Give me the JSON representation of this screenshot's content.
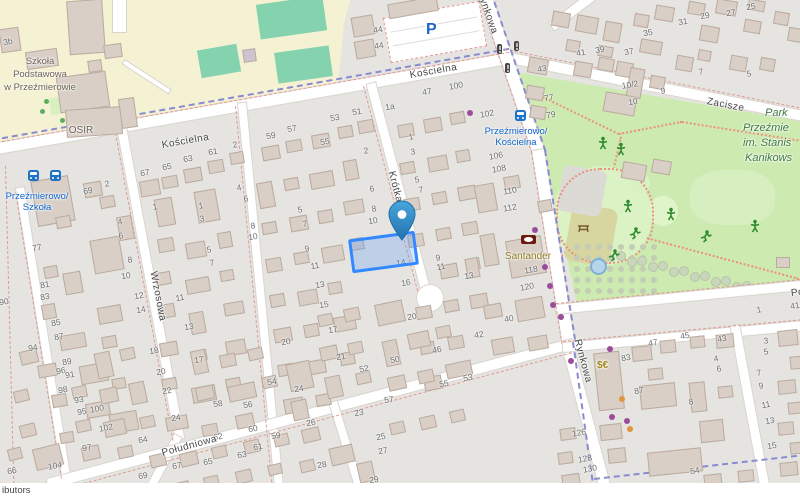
{
  "map": {
    "attribution_fragment": "ibutors",
    "streets": [
      {
        "name": "Kościelna"
      },
      {
        "name": "Kościelna"
      },
      {
        "name": "Zacisze"
      },
      {
        "name": "Wrzosowa"
      },
      {
        "name": "Krótka"
      },
      {
        "name": "Rynkowa"
      },
      {
        "name": "Rynkowa"
      },
      {
        "name": "Południowa"
      },
      {
        "name": "Południowa"
      }
    ],
    "places": {
      "school_lines": [
        "Szkoła",
        "Podstawowa",
        "w Przeźmierowie"
      ],
      "osir": "OSIR",
      "park_lines": [
        "Park",
        "Przeźmie",
        "im. Stanis",
        "Kanikows"
      ],
      "santander": "Santander",
      "parking": "P",
      "currency": "$€"
    },
    "bus_stops": [
      {
        "name_lines": [
          "Przeźmierowo/",
          "Szkoła"
        ]
      },
      {
        "name_lines": [
          "Przeźmierowo/",
          "Kościelna"
        ]
      }
    ],
    "house_numbers": [
      {
        "t": "3b",
        "x": 8,
        "y": 42
      },
      {
        "t": "44",
        "x": 378,
        "y": 30
      },
      {
        "t": "44",
        "x": 379,
        "y": 46
      },
      {
        "t": "100",
        "x": 456,
        "y": 86
      },
      {
        "t": "47",
        "x": 427,
        "y": 92
      },
      {
        "t": "1a",
        "x": 390,
        "y": 107
      },
      {
        "t": "102",
        "x": 487,
        "y": 114
      },
      {
        "t": "1",
        "x": 411,
        "y": 137
      },
      {
        "t": "43",
        "x": 542,
        "y": 69
      },
      {
        "t": "77",
        "x": 549,
        "y": 98
      },
      {
        "t": "79",
        "x": 551,
        "y": 115
      },
      {
        "t": "41",
        "x": 581,
        "y": 53
      },
      {
        "t": "39",
        "x": 600,
        "y": 50
      },
      {
        "t": "37",
        "x": 629,
        "y": 52
      },
      {
        "t": "35",
        "x": 648,
        "y": 33
      },
      {
        "t": "31",
        "x": 683,
        "y": 22
      },
      {
        "t": "29",
        "x": 705,
        "y": 16
      },
      {
        "t": "27",
        "x": 731,
        "y": 13
      },
      {
        "t": "25",
        "x": 751,
        "y": 7
      },
      {
        "t": "10/2",
        "x": 630,
        "y": 85
      },
      {
        "t": "10",
        "x": 633,
        "y": 102
      },
      {
        "t": "9",
        "x": 663,
        "y": 91
      },
      {
        "t": "7",
        "x": 701,
        "y": 72
      },
      {
        "t": "5",
        "x": 749,
        "y": 74
      },
      {
        "t": "61",
        "x": 213,
        "y": 152
      },
      {
        "t": "2",
        "x": 235,
        "y": 145
      },
      {
        "t": "59",
        "x": 271,
        "y": 136
      },
      {
        "t": "57",
        "x": 292,
        "y": 129
      },
      {
        "t": "55",
        "x": 325,
        "y": 142
      },
      {
        "t": "53",
        "x": 335,
        "y": 118
      },
      {
        "t": "51",
        "x": 357,
        "y": 112
      },
      {
        "t": "2",
        "x": 366,
        "y": 151
      },
      {
        "t": "3",
        "x": 413,
        "y": 152
      },
      {
        "t": "5",
        "x": 417,
        "y": 180
      },
      {
        "t": "7",
        "x": 421,
        "y": 190
      },
      {
        "t": "67",
        "x": 145,
        "y": 173
      },
      {
        "t": "65",
        "x": 167,
        "y": 167
      },
      {
        "t": "63",
        "x": 188,
        "y": 159
      },
      {
        "t": "69",
        "x": 88,
        "y": 191
      },
      {
        "t": "2",
        "x": 107,
        "y": 184
      },
      {
        "t": "1",
        "x": 155,
        "y": 207
      },
      {
        "t": "77",
        "x": 37,
        "y": 248
      },
      {
        "t": "4",
        "x": 120,
        "y": 222
      },
      {
        "t": "6",
        "x": 121,
        "y": 236
      },
      {
        "t": "8",
        "x": 130,
        "y": 260
      },
      {
        "t": "10",
        "x": 126,
        "y": 276
      },
      {
        "t": "81",
        "x": 45,
        "y": 285
      },
      {
        "t": "83",
        "x": 45,
        "y": 297
      },
      {
        "t": "85",
        "x": 56,
        "y": 323
      },
      {
        "t": "87",
        "x": 59,
        "y": 337
      },
      {
        "t": "90",
        "x": 4,
        "y": 302
      },
      {
        "t": "1",
        "x": 201,
        "y": 206
      },
      {
        "t": "3",
        "x": 202,
        "y": 219
      },
      {
        "t": "5",
        "x": 209,
        "y": 250
      },
      {
        "t": "7",
        "x": 212,
        "y": 263
      },
      {
        "t": "11",
        "x": 180,
        "y": 298
      },
      {
        "t": "12",
        "x": 139,
        "y": 296
      },
      {
        "t": "14",
        "x": 141,
        "y": 310
      },
      {
        "t": "13",
        "x": 189,
        "y": 327
      },
      {
        "t": "4",
        "x": 239,
        "y": 188
      },
      {
        "t": "6",
        "x": 246,
        "y": 199
      },
      {
        "t": "8",
        "x": 253,
        "y": 226
      },
      {
        "t": "10",
        "x": 253,
        "y": 237
      },
      {
        "t": "5",
        "x": 300,
        "y": 210
      },
      {
        "t": "7",
        "x": 305,
        "y": 224
      },
      {
        "t": "9",
        "x": 307,
        "y": 249
      },
      {
        "t": "11",
        "x": 315,
        "y": 266
      },
      {
        "t": "13",
        "x": 320,
        "y": 285
      },
      {
        "t": "15",
        "x": 324,
        "y": 305
      },
      {
        "t": "17",
        "x": 333,
        "y": 330
      },
      {
        "t": "21",
        "x": 341,
        "y": 357
      },
      {
        "t": "6",
        "x": 372,
        "y": 189
      },
      {
        "t": "8",
        "x": 374,
        "y": 209
      },
      {
        "t": "10",
        "x": 373,
        "y": 221
      },
      {
        "t": "14",
        "x": 401,
        "y": 263
      },
      {
        "t": "16",
        "x": 406,
        "y": 283
      },
      {
        "t": "20",
        "x": 412,
        "y": 317
      },
      {
        "t": "52",
        "x": 364,
        "y": 369
      },
      {
        "t": "50",
        "x": 395,
        "y": 360
      },
      {
        "t": "46",
        "x": 437,
        "y": 350
      },
      {
        "t": "9",
        "x": 438,
        "y": 258
      },
      {
        "t": "11",
        "x": 441,
        "y": 267
      },
      {
        "t": "13",
        "x": 469,
        "y": 276
      },
      {
        "t": "40",
        "x": 509,
        "y": 319
      },
      {
        "t": "42",
        "x": 479,
        "y": 335
      },
      {
        "t": "106",
        "x": 496,
        "y": 156
      },
      {
        "t": "108",
        "x": 499,
        "y": 169
      },
      {
        "t": "110",
        "x": 510,
        "y": 191
      },
      {
        "t": "112",
        "x": 510,
        "y": 208
      },
      {
        "t": "118",
        "x": 531,
        "y": 270
      },
      {
        "t": "120",
        "x": 527,
        "y": 287
      },
      {
        "t": "94",
        "x": 33,
        "y": 348
      },
      {
        "t": "96",
        "x": 61,
        "y": 371
      },
      {
        "t": "98",
        "x": 63,
        "y": 390
      },
      {
        "t": "100",
        "x": 97,
        "y": 409
      },
      {
        "t": "102",
        "x": 106,
        "y": 428
      },
      {
        "t": "104",
        "x": 55,
        "y": 466
      },
      {
        "t": "66",
        "x": 12,
        "y": 471
      },
      {
        "t": "89",
        "x": 67,
        "y": 362
      },
      {
        "t": "91",
        "x": 70,
        "y": 375
      },
      {
        "t": "93",
        "x": 79,
        "y": 400
      },
      {
        "t": "95",
        "x": 82,
        "y": 412
      },
      {
        "t": "97",
        "x": 87,
        "y": 448
      },
      {
        "t": "64",
        "x": 143,
        "y": 440
      },
      {
        "t": "62",
        "x": 218,
        "y": 437
      },
      {
        "t": "60",
        "x": 253,
        "y": 429
      },
      {
        "t": "18",
        "x": 154,
        "y": 351
      },
      {
        "t": "20",
        "x": 161,
        "y": 372
      },
      {
        "t": "22",
        "x": 167,
        "y": 391
      },
      {
        "t": "24",
        "x": 176,
        "y": 418
      },
      {
        "t": "17",
        "x": 199,
        "y": 360
      },
      {
        "t": "58",
        "x": 218,
        "y": 404
      },
      {
        "t": "56",
        "x": 248,
        "y": 405
      },
      {
        "t": "54",
        "x": 272,
        "y": 382
      },
      {
        "t": "24",
        "x": 299,
        "y": 389
      },
      {
        "t": "20",
        "x": 286,
        "y": 342
      },
      {
        "t": "26",
        "x": 311,
        "y": 423
      },
      {
        "t": "28",
        "x": 322,
        "y": 465
      },
      {
        "t": "59",
        "x": 276,
        "y": 436
      },
      {
        "t": "61",
        "x": 258,
        "y": 447
      },
      {
        "t": "63",
        "x": 242,
        "y": 455
      },
      {
        "t": "65",
        "x": 208,
        "y": 462
      },
      {
        "t": "67",
        "x": 177,
        "y": 466
      },
      {
        "t": "69",
        "x": 143,
        "y": 476
      },
      {
        "t": "23",
        "x": 359,
        "y": 413
      },
      {
        "t": "25",
        "x": 381,
        "y": 437
      },
      {
        "t": "27",
        "x": 383,
        "y": 451
      },
      {
        "t": "29",
        "x": 374,
        "y": 480
      },
      {
        "t": "57",
        "x": 389,
        "y": 400
      },
      {
        "t": "53",
        "x": 468,
        "y": 378
      },
      {
        "t": "55",
        "x": 444,
        "y": 384
      },
      {
        "t": "126",
        "x": 579,
        "y": 433
      },
      {
        "t": "128",
        "x": 585,
        "y": 459
      },
      {
        "t": "130",
        "x": 590,
        "y": 469
      },
      {
        "t": "83",
        "x": 626,
        "y": 358
      },
      {
        "t": "87",
        "x": 639,
        "y": 391
      },
      {
        "t": "8",
        "x": 691,
        "y": 402
      },
      {
        "t": "54",
        "x": 695,
        "y": 471
      },
      {
        "t": "4",
        "x": 716,
        "y": 359
      },
      {
        "t": "6",
        "x": 719,
        "y": 369
      },
      {
        "t": "43",
        "x": 722,
        "y": 339
      },
      {
        "t": "45",
        "x": 685,
        "y": 336
      },
      {
        "t": "47",
        "x": 653,
        "y": 343
      },
      {
        "t": "3",
        "x": 766,
        "y": 341
      },
      {
        "t": "5",
        "x": 766,
        "y": 352
      },
      {
        "t": "7",
        "x": 759,
        "y": 373
      },
      {
        "t": "9",
        "x": 761,
        "y": 386
      },
      {
        "t": "11",
        "x": 766,
        "y": 405
      },
      {
        "t": "13",
        "x": 770,
        "y": 421
      },
      {
        "t": "15",
        "x": 772,
        "y": 446
      },
      {
        "t": "41",
        "x": 795,
        "y": 306
      },
      {
        "t": "1",
        "x": 759,
        "y": 310
      }
    ],
    "colors": {
      "selection": "#3388ff",
      "marker": "#2e7fbe",
      "bus_label": "#0d62c9",
      "park_label": "#3c7a3c",
      "santander_label": "#8f7a1d",
      "parking": "#2065c9",
      "boundary_red": "#e09a93",
      "boundary_blue": "#8a8ad0"
    }
  }
}
